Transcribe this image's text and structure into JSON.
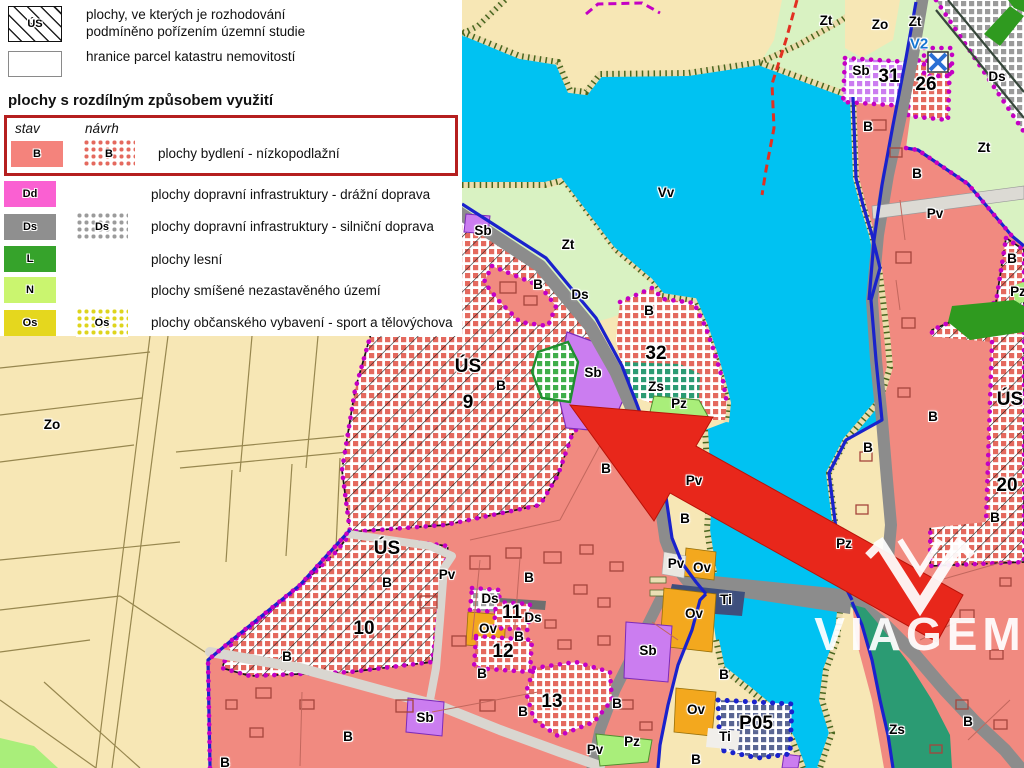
{
  "legend": {
    "header_items": [
      {
        "code": "ÚS",
        "chip": "us-hatch",
        "label": "plochy, ve kterých je rozhodování\npodmíněno pořízením územní studie"
      },
      {
        "code": "",
        "chip": "parcel",
        "label": "hranice parcel katastru nemovitostí"
      }
    ],
    "section_title": "plochy s rozdílným způsobem využití",
    "columns": {
      "stav": "stav",
      "navrh": "návrh"
    },
    "rows": [
      {
        "code": "B",
        "color": "#f4837c",
        "lattice": "#e4695e",
        "navrh": true,
        "highlight": true,
        "label": "plochy bydlení - nízkopodlažní"
      },
      {
        "code": "Dd",
        "color": "#fa60d2",
        "navrh": false,
        "label": "plochy dopravní infrastruktury - drážní doprava"
      },
      {
        "code": "Ds",
        "color": "#8f8f8f",
        "lattice": "#9b9b9b",
        "navrh": true,
        "label": "plochy dopravní infrastruktury - silniční doprava"
      },
      {
        "code": "L",
        "color": "#36a32b",
        "navrh": false,
        "label": "plochy lesní"
      },
      {
        "code": "N",
        "color": "#caf56f",
        "navrh": false,
        "label": "plochy smíšené nezastavěného území"
      },
      {
        "code": "Os",
        "color": "#e5d71e",
        "lattice": "#ded41c",
        "navrh": true,
        "label": "plochy občanského vybavení - sport a tělovýchova"
      }
    ]
  },
  "watermark": {
    "brand": "VIAGEM"
  },
  "colors": {
    "water": "#00c2f2",
    "tan": "#f7e7b5",
    "lightGreen": "#d9f2c2",
    "salmon": "#f18a80",
    "lattice": "#e4695e",
    "violet": "#cb7df0",
    "orange": "#f3a81e",
    "gray": "#8c8c8c",
    "teal": "#2b9b73",
    "brightGreen": "#a9ee7a",
    "forest": "#2f9a1f",
    "navy": "#3e4f7d",
    "magenta": "#c400c4",
    "blue": "#1a22cc",
    "arrow": "#e8271b",
    "highlight": "#b51f1f"
  },
  "map_labels": [
    {
      "t": "Zt",
      "x": 826,
      "y": 21
    },
    {
      "t": "Zo",
      "x": 880,
      "y": 25
    },
    {
      "t": "Zt",
      "x": 915,
      "y": 22
    },
    {
      "t": "V2",
      "x": 919,
      "y": 45,
      "c": "b"
    },
    {
      "t": "Sb",
      "x": 861,
      "y": 71
    },
    {
      "t": "31",
      "x": 889,
      "y": 78,
      "c": "n"
    },
    {
      "t": "26",
      "x": 926,
      "y": 86,
      "c": "n"
    },
    {
      "t": "Ds",
      "x": 997,
      "y": 77
    },
    {
      "t": "Zt",
      "x": 984,
      "y": 148
    },
    {
      "t": "B",
      "x": 868,
      "y": 127
    },
    {
      "t": "B",
      "x": 917,
      "y": 174
    },
    {
      "t": "Pv",
      "x": 935,
      "y": 214
    },
    {
      "t": "B",
      "x": 1012,
      "y": 259
    },
    {
      "t": "Pz",
      "x": 1018,
      "y": 292
    },
    {
      "t": "Vv",
      "x": 666,
      "y": 193
    },
    {
      "t": "Zt",
      "x": 568,
      "y": 245
    },
    {
      "t": "Sb",
      "x": 483,
      "y": 231
    },
    {
      "t": "B",
      "x": 538,
      "y": 285
    },
    {
      "t": "Ds",
      "x": 580,
      "y": 295
    },
    {
      "t": "B",
      "x": 649,
      "y": 311
    },
    {
      "t": "32",
      "x": 656,
      "y": 355,
      "c": "n"
    },
    {
      "t": "ÚS",
      "x": 468,
      "y": 368,
      "c": "n"
    },
    {
      "t": "B",
      "x": 501,
      "y": 386
    },
    {
      "t": "9",
      "x": 468,
      "y": 404,
      "c": "n"
    },
    {
      "t": "Sb",
      "x": 593,
      "y": 373
    },
    {
      "t": "Zs",
      "x": 656,
      "y": 387
    },
    {
      "t": "Pz",
      "x": 679,
      "y": 404
    },
    {
      "t": "B",
      "x": 933,
      "y": 417
    },
    {
      "t": "ÚS",
      "x": 1010,
      "y": 401,
      "c": "n"
    },
    {
      "t": "20",
      "x": 1007,
      "y": 487,
      "c": "n"
    },
    {
      "t": "B",
      "x": 995,
      "y": 518
    },
    {
      "t": "B",
      "x": 606,
      "y": 469
    },
    {
      "t": "Pv",
      "x": 694,
      "y": 481
    },
    {
      "t": "B",
      "x": 685,
      "y": 519
    },
    {
      "t": "B",
      "x": 868,
      "y": 448
    },
    {
      "t": "Zo",
      "x": 52,
      "y": 425
    },
    {
      "t": "ÚS",
      "x": 387,
      "y": 550,
      "c": "n"
    },
    {
      "t": "B",
      "x": 387,
      "y": 583
    },
    {
      "t": "Pv",
      "x": 447,
      "y": 575
    },
    {
      "t": "B",
      "x": 529,
      "y": 578
    },
    {
      "t": "Ds",
      "x": 490,
      "y": 599
    },
    {
      "t": "11",
      "x": 512,
      "y": 614,
      "c": "n"
    },
    {
      "t": "Ds",
      "x": 533,
      "y": 618
    },
    {
      "t": "Ov",
      "x": 488,
      "y": 629
    },
    {
      "t": "B",
      "x": 519,
      "y": 637
    },
    {
      "t": "12",
      "x": 503,
      "y": 653,
      "c": "n"
    },
    {
      "t": "10",
      "x": 364,
      "y": 630,
      "c": "n"
    },
    {
      "t": "B",
      "x": 482,
      "y": 674
    },
    {
      "t": "B",
      "x": 287,
      "y": 657
    },
    {
      "t": "Sb",
      "x": 425,
      "y": 718
    },
    {
      "t": "B",
      "x": 348,
      "y": 737
    },
    {
      "t": "B",
      "x": 225,
      "y": 763
    },
    {
      "t": "13",
      "x": 552,
      "y": 703,
      "c": "n"
    },
    {
      "t": "B",
      "x": 523,
      "y": 712
    },
    {
      "t": "Sb",
      "x": 648,
      "y": 651
    },
    {
      "t": "B",
      "x": 617,
      "y": 704
    },
    {
      "t": "Pz",
      "x": 632,
      "y": 742
    },
    {
      "t": "Pv",
      "x": 595,
      "y": 750
    },
    {
      "t": "Pv",
      "x": 676,
      "y": 564
    },
    {
      "t": "Ov",
      "x": 702,
      "y": 568
    },
    {
      "t": "Ti",
      "x": 726,
      "y": 600
    },
    {
      "t": "Ov",
      "x": 694,
      "y": 614
    },
    {
      "t": "B",
      "x": 724,
      "y": 675
    },
    {
      "t": "Ov",
      "x": 696,
      "y": 710
    },
    {
      "t": "P05",
      "x": 756,
      "y": 725,
      "c": "n"
    },
    {
      "t": "Ti",
      "x": 725,
      "y": 737
    },
    {
      "t": "Zs",
      "x": 897,
      "y": 730
    },
    {
      "t": "B",
      "x": 968,
      "y": 722
    },
    {
      "t": "Pz",
      "x": 844,
      "y": 544
    },
    {
      "t": "B",
      "x": 696,
      "y": 760
    }
  ]
}
